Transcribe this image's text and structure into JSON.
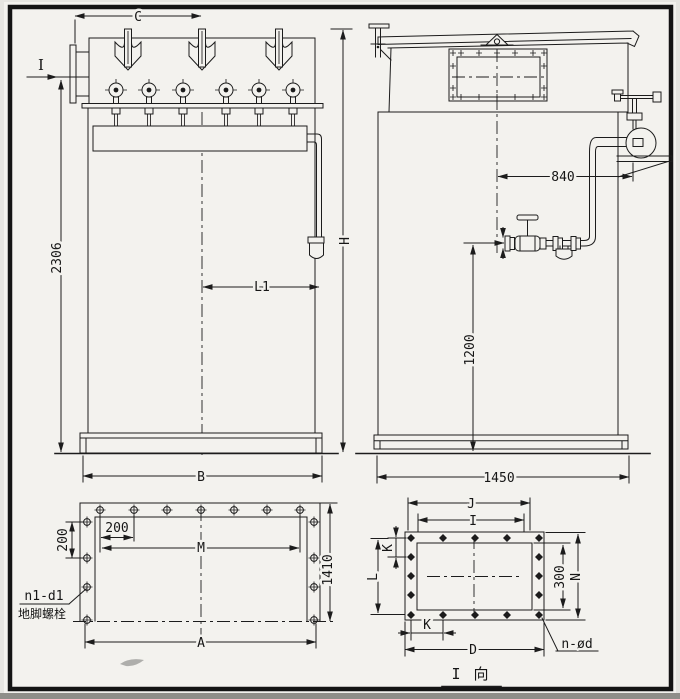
{
  "colors": {
    "line": "#1c1c1c",
    "paper": "#f3f2ee",
    "frame": "#141414"
  },
  "labels": {
    "front": {
      "width_c": "C",
      "view_arrow": "I",
      "height_2306": "2306",
      "center_l1": "L1",
      "base_width_b": "B",
      "total_height_h": "H"
    },
    "side": {
      "gauge_offset_840": "840",
      "inlet_height_1200": "1200",
      "base_depth_1450": "1450"
    },
    "base_plan": {
      "pitch_v_200": "200",
      "pitch_h_200": "200",
      "bolt_span_m": "M",
      "base_length_a": "A",
      "base_depth_1410": "1410",
      "anchor_code": "n1-d1",
      "anchor_name": "地脚螺栓"
    },
    "flange": {
      "outer_width_j": "J",
      "bolt_width_i": "I",
      "pitch_k_top": "K",
      "bolt_height_l": "L",
      "pitch_k_bottom": "K",
      "length_d": "D",
      "opening_height_300": "300",
      "outer_height_n": "N",
      "bolt_note": "n-ød",
      "caption": "I 向"
    }
  }
}
